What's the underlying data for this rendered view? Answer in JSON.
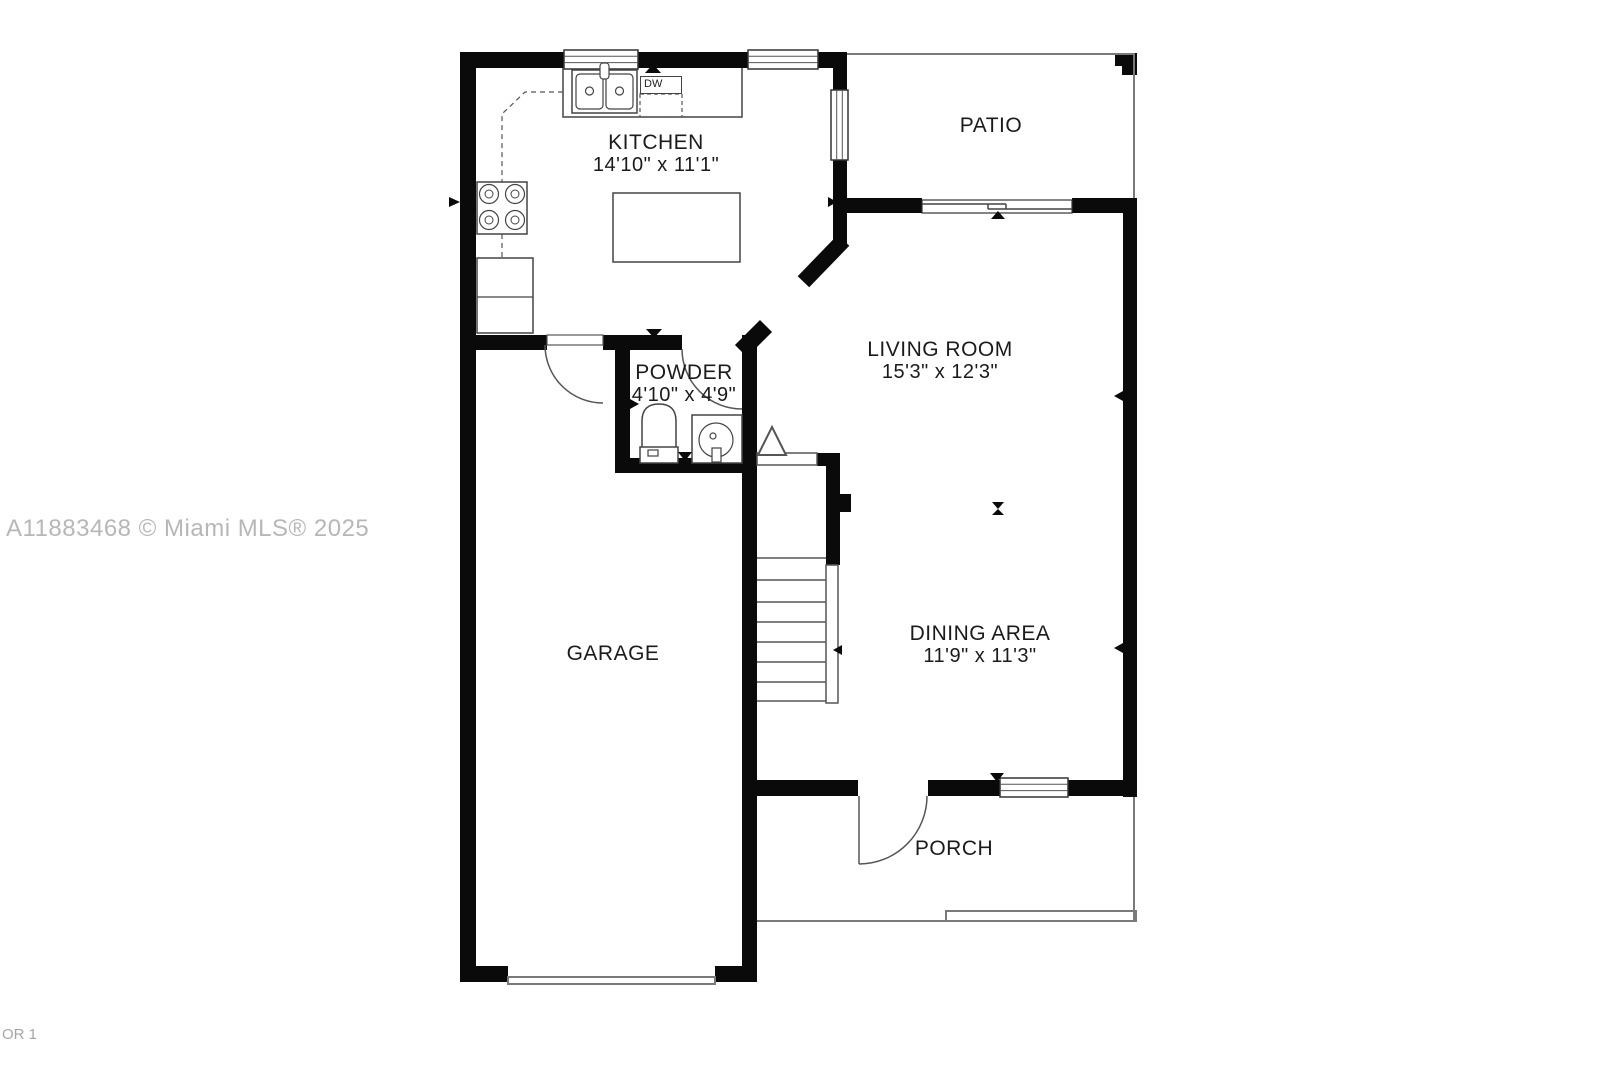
{
  "watermark": "A11883468 © Miami MLS® 2025",
  "floor_label": "OR 1",
  "rooms": {
    "kitchen": {
      "name": "KITCHEN",
      "dims": "14'10\" x 11'1\""
    },
    "patio": {
      "name": "PATIO"
    },
    "living_room": {
      "name": "LIVING ROOM",
      "dims": "15'3\" x 12'3\""
    },
    "powder": {
      "name": "POWDER",
      "dims": "4'10\" x 4'9\""
    },
    "garage": {
      "name": "GARAGE"
    },
    "dining_area": {
      "name": "DINING AREA",
      "dims": "11'9\" x 11'3\""
    },
    "porch": {
      "name": "PORCH"
    }
  },
  "appliances": {
    "dishwasher_label": "DW"
  },
  "colors": {
    "wall": "#0a0a0a",
    "fixture_line": "#444444",
    "thin_outline": "#7a7a7a",
    "label_text": "#1b1b1b",
    "watermark_text": "#b7b7b7"
  }
}
